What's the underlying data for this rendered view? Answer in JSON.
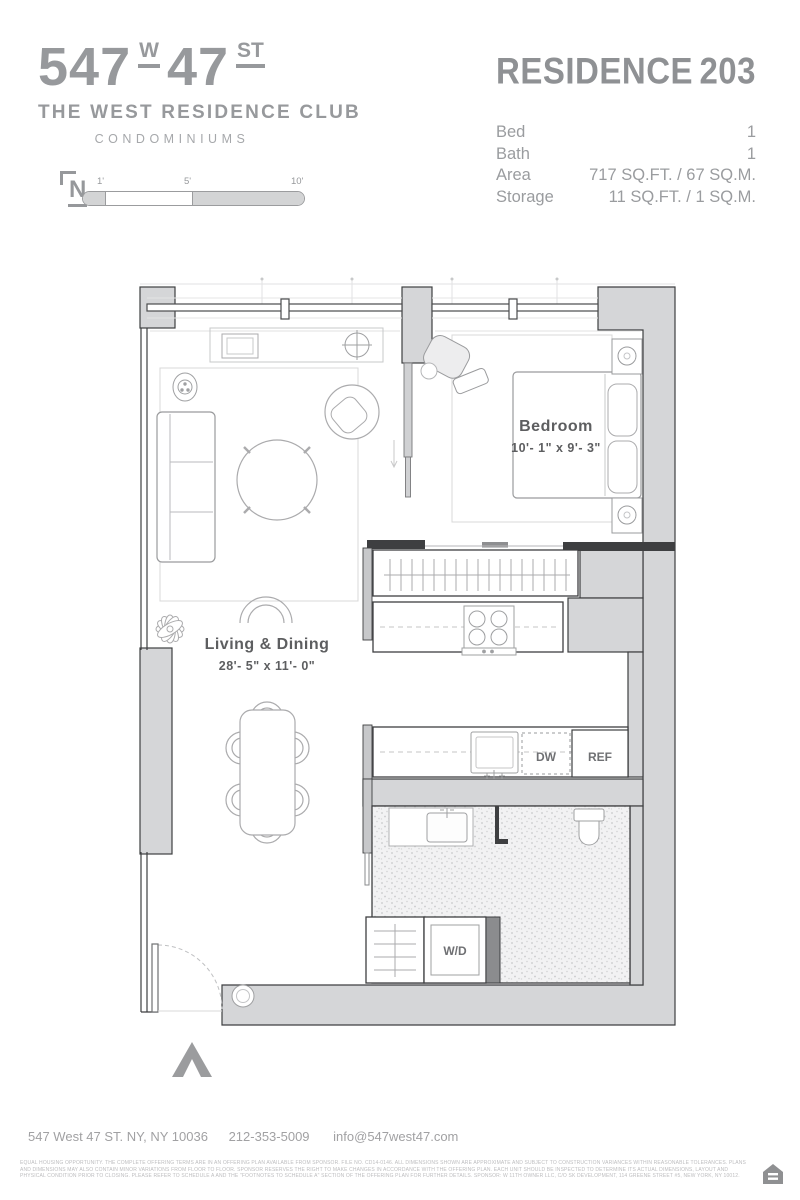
{
  "branding": {
    "address_big_left": "547",
    "address_small_w": "W",
    "address_big_right": "47",
    "address_small_st": "ST",
    "club_name": "THE WEST RESIDENCE CLUB",
    "building_type": "CONDOMINIUMS"
  },
  "residence": {
    "title": "RESIDENCE",
    "number": "203"
  },
  "specs": {
    "rows": [
      {
        "label": "Bed",
        "value": "1"
      },
      {
        "label": "Bath",
        "value": "1"
      },
      {
        "label": "Area",
        "value": "717 SQ.FT. / 67 SQ.M."
      },
      {
        "label": "Storage",
        "value": "11 SQ.FT. / 1 SQ.M."
      }
    ]
  },
  "scale_bar": {
    "north_label": "N",
    "ticks": [
      "1'",
      "5'",
      "10'"
    ]
  },
  "plan": {
    "rooms": [
      {
        "name": "Bedroom",
        "dimensions": "10'- 1\" x 9'- 3\""
      },
      {
        "name": "Living & Dining",
        "dimensions": "28'- 5\" x 11'- 0\""
      }
    ],
    "appliances": {
      "dishwasher": "DW",
      "refrigerator": "REF",
      "washer_dryer": "W/D"
    }
  },
  "footer": {
    "address": "547 West 47 ST. NY, NY 10036",
    "phone": "212-353-5009",
    "email": "info@547west47.com",
    "legal": "EQUAL HOUSING OPPORTUNITY. THE COMPLETE OFFERING TERMS ARE IN AN OFFERING PLAN AVAILABLE FROM SPONSOR. FILE NO. CD14-0146. ALL DIMENSIONS SHOWN ARE APPROXIMATE AND SUBJECT TO CONSTRUCTION VARIANCES WITHIN REASONABLE TOLERANCES. PLANS AND DIMENSIONS MAY ALSO CONTAIN MINOR VARIATIONS FROM FLOOR TO FLOOR. SPONSOR RESERVES THE RIGHT TO MAKE CHANGES IN ACCORDANCE WITH THE OFFERING PLAN. EACH UNIT SHOULD BE INSPECTED TO DETERMINE ITS ACTUAL DIMENSIONS, LAYOUT AND PHYSICAL CONDITION PRIOR TO CLOSING. PLEASE REFER TO SCHEDULE A AND THE \"FOOTNOTES TO SCHEDULE A\" SECTION OF THE OFFERING PLAN FOR FURTHER DETAILS. SPONSOR: W 11TH OWNER LLC, C/O SK DEVELOPMENT, 114 GREENE STREET #5, NEW YORK, NY 10012."
  },
  "colors": {
    "header_gray": "#97999c",
    "wall_fill": "#d5d6d8",
    "wall_line": "#3e3f41",
    "furniture_line": "#a9abad"
  }
}
